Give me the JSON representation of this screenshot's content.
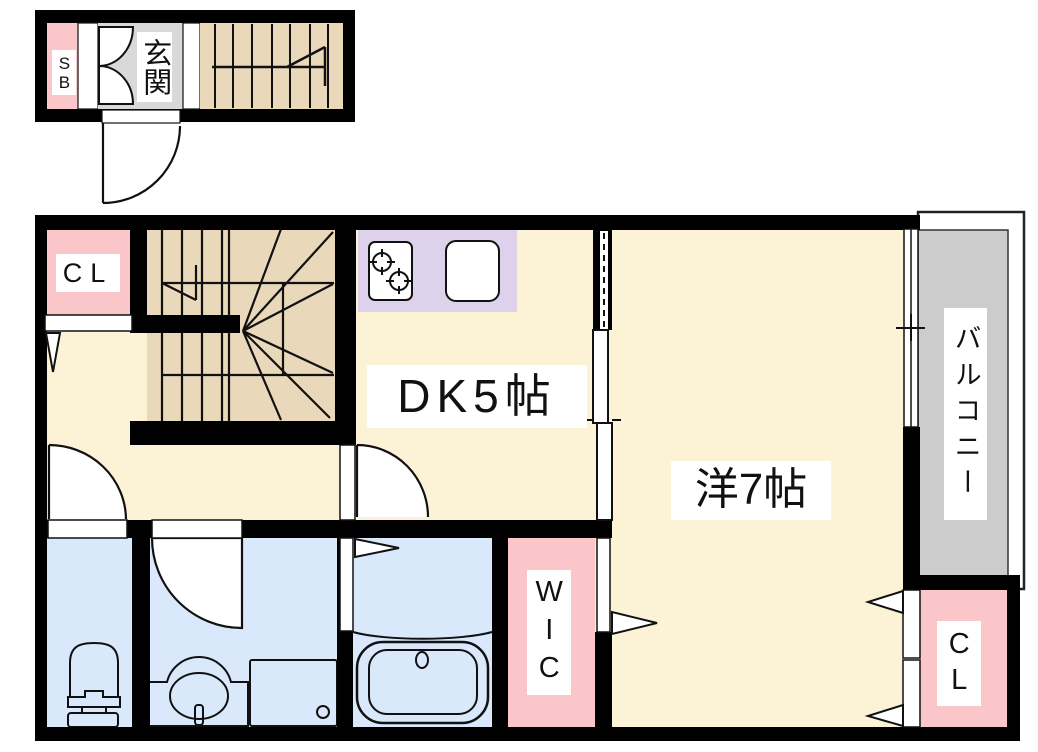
{
  "upper_floor_section": {
    "shoe_box": {
      "label": "SB"
    },
    "entrance": {
      "label": "玄関"
    }
  },
  "main_floor": {
    "closet_top": {
      "label": "CL"
    },
    "dining_kitchen": {
      "label": "DK5帖",
      "size_jo": 5
    },
    "western_room": {
      "label": "洋7帖",
      "size_jo": 7
    },
    "walk_in_closet": {
      "label": "WIC"
    },
    "closet_bottom": {
      "label": "CL"
    },
    "balcony": {
      "label": "バルコニー"
    }
  },
  "colors": {
    "room_cream": "#fcf3d6",
    "closet_pink": "#fbc6c9",
    "stairs_tan": "#e9d8ba",
    "kitchen_lavender": "#ddd1eb",
    "wet_area_blue": "#d9e9fb",
    "balcony_gray": "#cccccc",
    "entrance_gray": "#d9d9d9",
    "wall_black": "#000000",
    "line_black": "#111111"
  }
}
